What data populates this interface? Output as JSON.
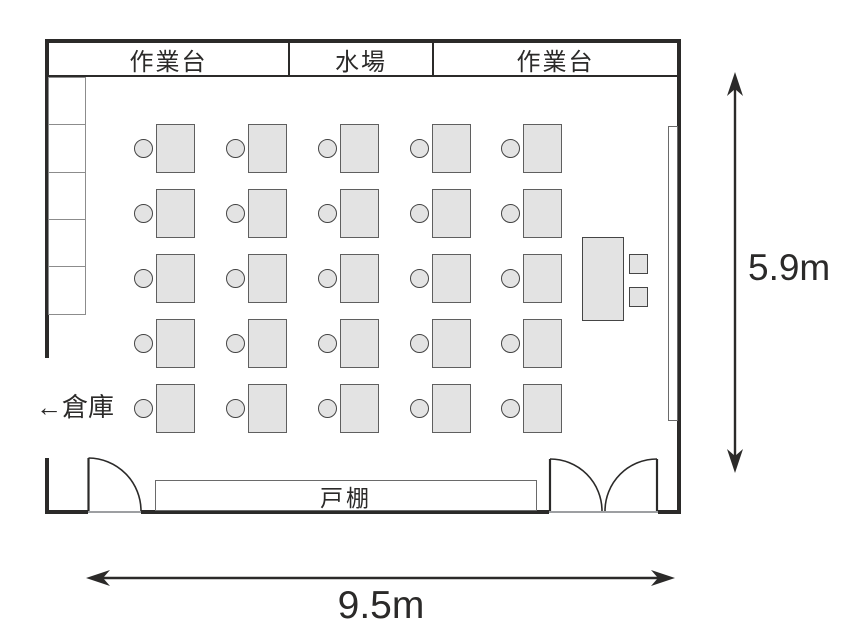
{
  "floor_plan": {
    "labels": {
      "counter_left": "作業台",
      "sink": "水場",
      "counter_right": "作業台",
      "storage_arrow": "←倉庫",
      "cupboard": "戸棚"
    },
    "dimensions": {
      "height": "5.9m",
      "width": "9.5m"
    },
    "furniture": {
      "student_desk_grid": {
        "rows": 5,
        "cols": 5,
        "cols_x": [
          156,
          248,
          340,
          432,
          523
        ],
        "rows_y": [
          124,
          189,
          254,
          319,
          384
        ],
        "desk_w": 39,
        "desk_h": 49,
        "chair_d": 19
      },
      "locker_count": 5,
      "teacher_desk": true,
      "side_squares": 2,
      "whiteboard": true
    },
    "colors": {
      "line": "#2b2a29",
      "furniture_fill": "#e3e3e3",
      "furniture_border": "#5f5f5f",
      "locker_border": "#8c8c8c",
      "threshold": "#9d9fa2"
    }
  }
}
